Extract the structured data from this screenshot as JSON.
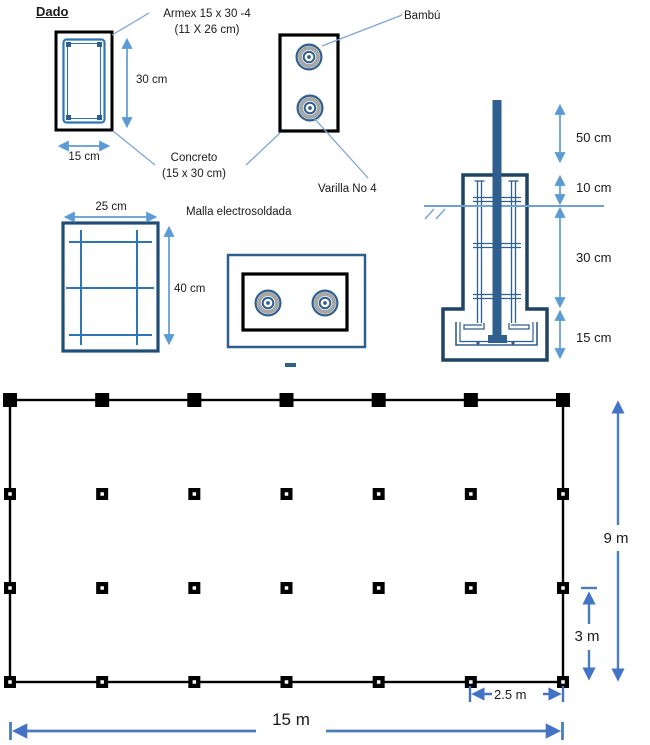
{
  "sections": {
    "dado": {
      "title": "Dado",
      "armex_label": [
        "Armex  15 x 30 -4",
        "(11 X 26 cm)"
      ],
      "concrete_label": [
        "Concreto",
        "(15 x 30 cm)"
      ],
      "height_dim": "30 cm",
      "width_dim": "15 cm"
    },
    "column_section": {
      "bamboo_label": "Bambú",
      "rebar_label": "Varilla No 4"
    },
    "mesh": {
      "label": "Malla electrosoldada",
      "width_dim": "25 cm",
      "height_dim": "40 cm"
    },
    "foundation": {
      "dims": [
        "50 cm",
        "10 cm",
        "30 cm",
        "15 cm"
      ]
    },
    "plan": {
      "grid_columns": 7,
      "grid_rows": 4,
      "height_dim": "9 m",
      "bay_height_dim": "3 m",
      "bay_width_dim": "2.5 m",
      "width_dim": "15 m"
    }
  },
  "colors": {
    "outline_navy": "#1f4365",
    "medium_blue": "#2e75b6",
    "pole_blue": "#2e5f8f",
    "dim_light_blue": "#5b9bd5",
    "plan_dim_blue": "#4472c4",
    "gray_ring": "#a6a6a6",
    "black": "#000000"
  }
}
